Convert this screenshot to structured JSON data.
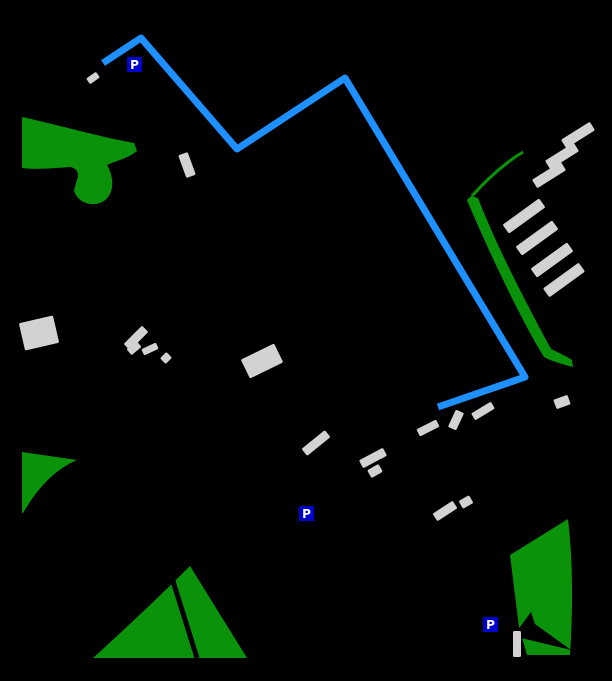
{
  "map": {
    "background": "#000000",
    "colors": {
      "route": "#1E90FF",
      "green": "#0A930A",
      "building": "#D2D2D2"
    },
    "route": {
      "points": [
        [
          103,
          63
        ],
        [
          141,
          38
        ],
        [
          237,
          149
        ],
        [
          345,
          78
        ],
        [
          525,
          377
        ],
        [
          438,
          407
        ]
      ],
      "width": 7
    },
    "parks": [
      {
        "name": "park-upper-left",
        "d": "M22,117 C55,124 100,137 134,143 L137,151 C127,159 115,161 107,165 C114,177 115,193 104,201 C93,208 78,203 74,191 C76,180 83,171 71,167 C54,168 36,170 22,168 Z"
      },
      {
        "name": "tree-strip-right",
        "d": "M471,196 L478,198 C498,250 532,314 551,349 C559,353 566,356 572,360 L573,367 C562,364 551,361 544,357 C521,320 488,250 467,200 Z"
      },
      {
        "name": "park-triangle-left",
        "d": "M22,452 L77,460 Q46,473 23,513 L22,513 Z"
      },
      {
        "name": "park-triangle-bottom",
        "d": "M190,566 Q148,608 93,658 L247,658 Z"
      },
      {
        "name": "park-bottom-right",
        "d": "M568,519 L510,555 L519,627 L527,655 L570,655 C573,610 573,560 568,519 Z"
      }
    ],
    "green_lines": [
      {
        "name": "tree-line-right",
        "d": "M523,152 Q498,167 472,196",
        "width": 3
      }
    ],
    "cuts": [
      {
        "name": "path-through-park",
        "type": "line",
        "x1": 172,
        "y1": 578,
        "x2": 197,
        "y2": 658,
        "width": 5
      },
      {
        "name": "park-notch",
        "type": "path",
        "d": "M517,631 L531,612 L535,624 L571,650 L517,637 Z"
      }
    ],
    "buildings": [
      {
        "cx": 93,
        "cy": 78,
        "w": 12,
        "h": 7,
        "rot": -35
      },
      {
        "cx": 187,
        "cy": 165,
        "w": 10,
        "h": 24,
        "rot": -20
      },
      {
        "cx": 39,
        "cy": 333,
        "w": 35,
        "h": 28,
        "rot": -13
      },
      {
        "cx": 136,
        "cy": 338,
        "w": 26,
        "h": 9,
        "rot": -45
      },
      {
        "cx": 134,
        "cy": 348,
        "w": 13,
        "h": 8,
        "rot": -40
      },
      {
        "cx": 150,
        "cy": 349,
        "w": 16,
        "h": 7,
        "rot": -25
      },
      {
        "cx": 166,
        "cy": 358,
        "w": 9,
        "h": 8,
        "rot": -45
      },
      {
        "cx": 262,
        "cy": 361,
        "w": 37,
        "h": 21,
        "rot": -26
      },
      {
        "cx": 316,
        "cy": 443,
        "w": 30,
        "h": 9,
        "rot": -39
      },
      {
        "cx": 373,
        "cy": 458,
        "w": 27,
        "h": 9,
        "rot": -28
      },
      {
        "cx": 375,
        "cy": 471,
        "w": 13,
        "h": 9,
        "rot": -30
      },
      {
        "cx": 428,
        "cy": 428,
        "w": 22,
        "h": 8,
        "rot": -27
      },
      {
        "cx": 456,
        "cy": 420,
        "w": 9,
        "h": 19,
        "rot": 25
      },
      {
        "cx": 483,
        "cy": 411,
        "w": 23,
        "h": 8,
        "rot": -31
      },
      {
        "cx": 445,
        "cy": 511,
        "w": 24,
        "h": 9,
        "rot": -33
      },
      {
        "cx": 466,
        "cy": 502,
        "w": 12,
        "h": 9,
        "rot": -30
      },
      {
        "cx": 578,
        "cy": 135,
        "w": 34,
        "h": 10,
        "rot": -32
      },
      {
        "cx": 562,
        "cy": 156,
        "w": 34,
        "h": 10,
        "rot": -32
      },
      {
        "cx": 549,
        "cy": 175,
        "w": 34,
        "h": 10,
        "rot": -32
      },
      {
        "cx": 524,
        "cy": 216,
        "w": 45,
        "h": 11,
        "rot": -36
      },
      {
        "cx": 537,
        "cy": 238,
        "w": 45,
        "h": 11,
        "rot": -36
      },
      {
        "cx": 552,
        "cy": 260,
        "w": 45,
        "h": 11,
        "rot": -36
      },
      {
        "cx": 564,
        "cy": 280,
        "w": 44,
        "h": 11,
        "rot": -36
      },
      {
        "cx": 562,
        "cy": 402,
        "w": 15,
        "h": 10,
        "rot": -20
      },
      {
        "cx": 517,
        "cy": 644,
        "w": 8,
        "h": 26,
        "rot": 0
      }
    ],
    "parking": {
      "label": "P",
      "bg": "#0000CC",
      "fg": "#FFFFFF",
      "size": 15,
      "icons": [
        {
          "x": 127,
          "y": 57
        },
        {
          "x": 299,
          "y": 506
        },
        {
          "x": 483,
          "y": 617
        }
      ]
    }
  }
}
